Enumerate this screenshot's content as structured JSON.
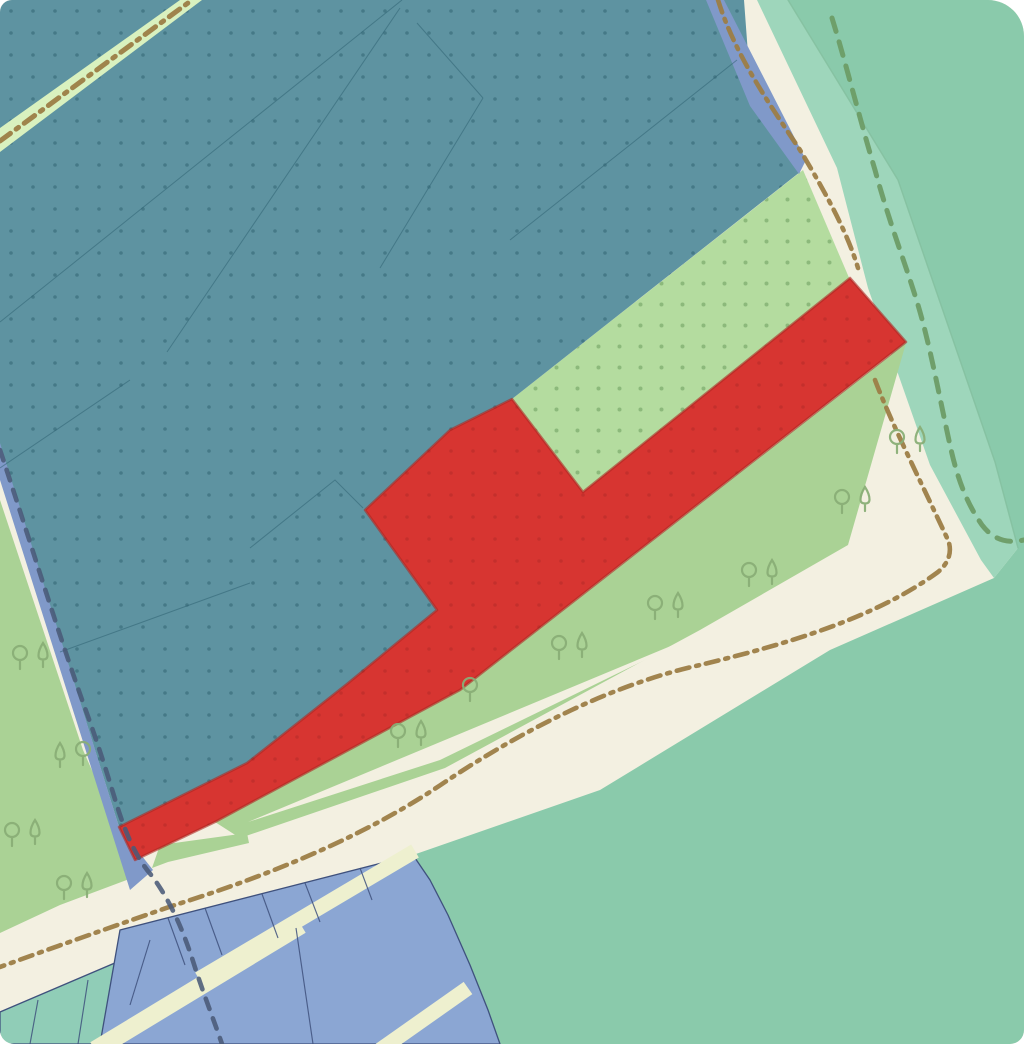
{
  "map": {
    "width": 1024,
    "height": 1044,
    "corner_radius": "12px 36px 14px 14px",
    "palette": {
      "cream": "#f3f0e1",
      "main_green": "#8acaab",
      "light_band": "#9ed6bb",
      "green": "#aad295",
      "pale_dotted": "#b4dc9f",
      "teal": "#5e93a1",
      "path_strip": "#d9f1bf",
      "blue": "#8099c9",
      "red": "#d73531",
      "red_edge": "rgba(173,38,33,0.6)",
      "blue_parcel": "#8ba6d3",
      "teal_parcel": "#90cdb7",
      "parcel_outline": "#3f517d",
      "minor_road": "#eef0cf",
      "brown_dash": "#9c7d46",
      "navy_dash": "#4a5a78",
      "green_dash": "#6d9c66",
      "tree": "#8aae76",
      "teal_parcel_line": "#2f6373",
      "band_edge": "#84c0a0"
    },
    "dot_patterns": {
      "teal": {
        "size": 22,
        "r": 1.8,
        "color": "rgba(30,80,92,0.38)"
      },
      "pale": {
        "size": 21,
        "r": 2.0,
        "color": "rgba(100,150,88,0.50)"
      },
      "red": {
        "size": 22,
        "r": 1.8,
        "color": "rgba(120,25,25,0.20)"
      }
    },
    "zones": [
      {
        "id": "background-roads",
        "fill": "cream",
        "points": "0,0 1024,0 1024,1044 0,1044"
      },
      {
        "id": "main-green-area",
        "fill": "main_green",
        "points": "788,0 1024,0 1024,1044 500,1044 488,1010 470,965 448,915 430,880 413,855 600,790 830,650 994,578 1018,548 995,462 898,180"
      },
      {
        "id": "light-green-band",
        "fill": "light_band",
        "points": "757,0 788,0 898,180 995,462 1018,548 994,578 981,560 930,465 868,288 837,168"
      },
      {
        "id": "left-green-area",
        "fill": "green",
        "points": "0,500 83,750 125,845 148,872 60,905 0,933"
      },
      {
        "id": "scrub-green-area",
        "fill": "green",
        "points": "215,822 460,690 906,343 848,545 700,630 445,768 240,838"
      },
      {
        "id": "scrub-road-sliver",
        "fill": "cream",
        "points": "248,822 690,638 440,760"
      },
      {
        "id": "junction-green-sliver",
        "fill": "green",
        "points": "152,868 160,845 247,833 249,843 168,862"
      },
      {
        "id": "pale-dotted-zone",
        "fill": "pale_dotted",
        "dots": "pale",
        "points": "512,399 803,170 850,280 583,492"
      },
      {
        "id": "teal-dotted-zone",
        "fill": "teal",
        "dots": "teal",
        "points": "0,0 744,0 752,108 800,172 512,399 450,430 365,510 437,610 347,684 247,763 119,827 0,445"
      },
      {
        "id": "path-strip-topleft",
        "fill": "path_strip",
        "points": "0,128 180,0 202,0 0,152"
      },
      {
        "id": "blue-strip-left",
        "fill": "blue",
        "points": "0,443 119,827 153,870 130,890 0,480"
      },
      {
        "id": "blue-strip-topright",
        "fill": "blue",
        "points": "706,0 724,0 806,160 799,174 750,106"
      },
      {
        "id": "red-zone",
        "fill": "red",
        "dots": "red",
        "stroke": "red_edge",
        "stroke_width": 2.5,
        "points": "512,399 583,492 850,278 906,342 460,690 215,822 135,860 119,827 247,763 347,684 437,610 365,510 450,430"
      },
      {
        "id": "teal-parcels-bottomleft",
        "fill": "teal_parcel",
        "stroke": "parcel_outline",
        "stroke_width": 1.3,
        "points": "0,1012 150,948 143,1044 0,1044"
      },
      {
        "id": "blue-parcels-bottom",
        "fill": "blue_parcel",
        "stroke": "parcel_outline",
        "stroke_width": 1.3,
        "points": "120,930 413,855 430,880 448,915 470,965 488,1010 500,1044 100,1044"
      }
    ],
    "minor_roads": [
      {
        "id": "minor-road-a",
        "points": "301,925 95,1050",
        "width": 18
      },
      {
        "id": "minor-road-b",
        "points": "415,851 199,979",
        "width": 15
      },
      {
        "id": "minor-road-c",
        "points": "468,988 380,1050",
        "width": 15
      }
    ],
    "parcel_dividers": [
      "168,918 185,965",
      "205,908 222,955",
      "262,894 278,938",
      "305,883 320,922",
      "360,868 372,900",
      "296,928 313,1044",
      "150,940 130,1005",
      "38,1000 30,1044",
      "88,980 78,1044"
    ],
    "teal_parcel_lines": [
      "0,322 402,0",
      "167,352 400,8",
      "0,468 130,380",
      "250,548 335,480 363,508",
      "483,98 380,268",
      "417,23 483,98",
      "510,240 737,60",
      "60,652 250,583"
    ],
    "boundary_lines": [
      {
        "id": "band-edge-line",
        "color": "band_edge",
        "width": 1.4,
        "dash": "",
        "opacity": 0.9,
        "path": "M788,0 L898,180 L995,462 L1018,548"
      },
      {
        "id": "road-dashdot-topleft",
        "color": "brown_dash",
        "width": 5,
        "dash": "13 7 3 7",
        "opacity": 0.95,
        "path": "M0,141 L192,0"
      },
      {
        "id": "road-dashdot-main",
        "color": "brown_dash",
        "width": 4.6,
        "dash": "13 7 3 7",
        "opacity": 0.95,
        "path": "M718,0 C735,55 770,105 800,150 C830,200 848,235 858,268 M875,380 C890,420 920,480 948,540 C952,550 950,562 938,572 C870,622 770,648 700,665 C610,685 520,732 445,782 C360,840 260,878 175,905 C140,917 60,945 0,967"
      },
      {
        "id": "admin-boundary-dashed",
        "color": "navy_dash",
        "width": 4.6,
        "dash": "11 10",
        "opacity": 0.88,
        "path": "M0,450 C30,540 60,640 90,722 C105,765 112,790 119,812 C130,845 140,862 152,876 C168,898 180,922 192,958 C202,990 212,1015 222,1044"
      },
      {
        "id": "footpath-dashed-green",
        "color": "green_dash",
        "width": 5,
        "dash": "14 11",
        "opacity": 0.95,
        "path": "M832,18 C845,60 860,120 875,170 C890,225 905,262 918,305 C930,345 940,400 950,445 C958,482 968,505 982,525 C995,542 1010,543 1024,540"
      }
    ],
    "trees": [
      {
        "type": "round",
        "x": 20,
        "y": 668
      },
      {
        "type": "conifer",
        "x": 43,
        "y": 666
      },
      {
        "type": "conifer",
        "x": 60,
        "y": 766
      },
      {
        "type": "round",
        "x": 83,
        "y": 764
      },
      {
        "type": "round",
        "x": 12,
        "y": 845
      },
      {
        "type": "conifer",
        "x": 35,
        "y": 843
      },
      {
        "type": "round",
        "x": 64,
        "y": 898
      },
      {
        "type": "conifer",
        "x": 87,
        "y": 896
      },
      {
        "type": "round",
        "x": 897,
        "y": 452
      },
      {
        "type": "conifer",
        "x": 920,
        "y": 450
      },
      {
        "type": "round",
        "x": 842,
        "y": 512
      },
      {
        "type": "conifer",
        "x": 865,
        "y": 510
      },
      {
        "type": "round",
        "x": 749,
        "y": 585
      },
      {
        "type": "conifer",
        "x": 772,
        "y": 583
      },
      {
        "type": "round",
        "x": 655,
        "y": 618
      },
      {
        "type": "conifer",
        "x": 678,
        "y": 616
      },
      {
        "type": "round",
        "x": 559,
        "y": 658
      },
      {
        "type": "conifer",
        "x": 582,
        "y": 656
      },
      {
        "type": "round",
        "x": 398,
        "y": 746
      },
      {
        "type": "conifer",
        "x": 421,
        "y": 744
      },
      {
        "type": "round",
        "x": 470,
        "y": 700
      }
    ]
  }
}
